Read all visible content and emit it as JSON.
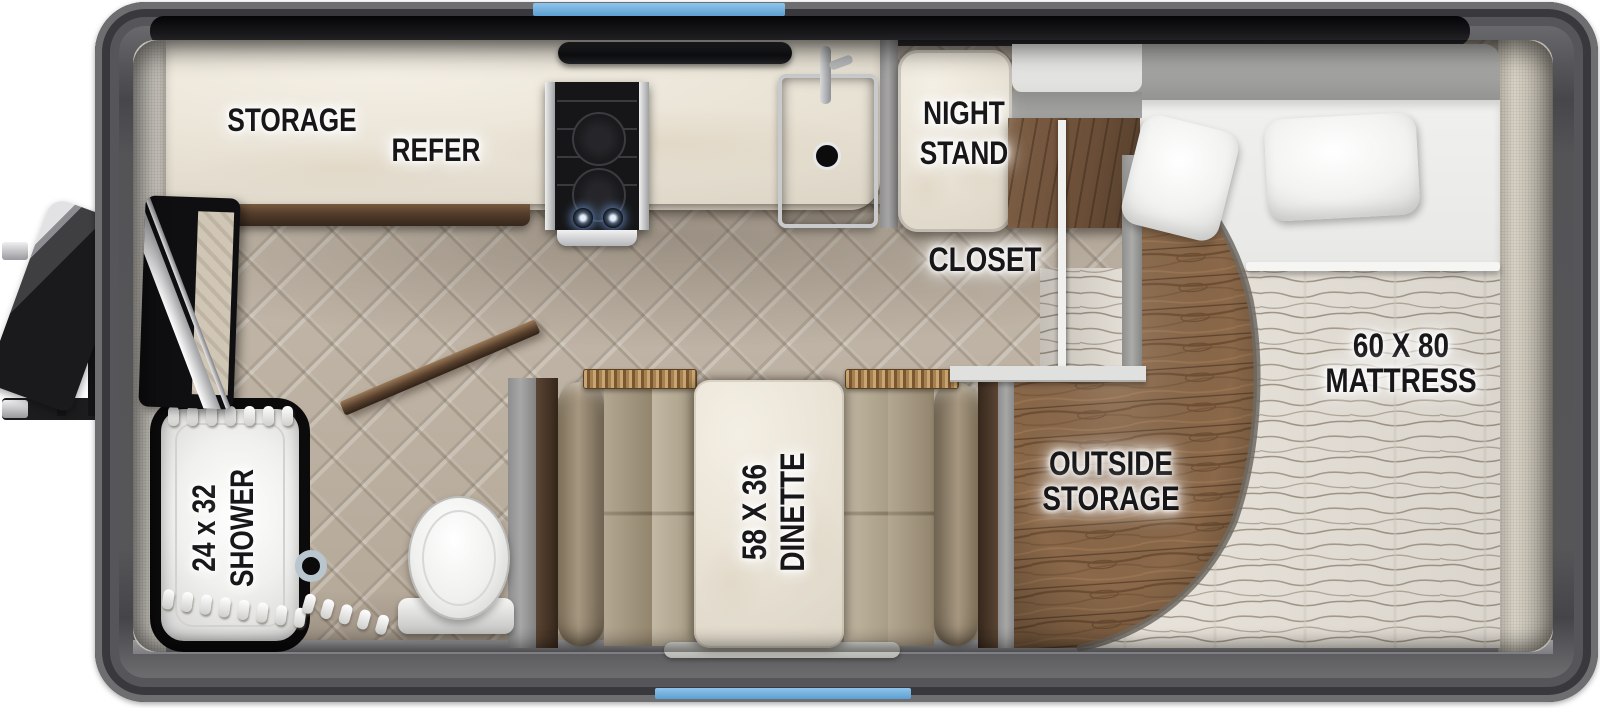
{
  "labels": {
    "storage": "STORAGE",
    "refer": "REFER",
    "night_stand_l1": "NIGHT",
    "night_stand_l2": "STAND",
    "closet": "CLOSET",
    "mattress_l1": "60 X 80",
    "mattress_l2": "MATTRESS",
    "outside_l1": "OUTSIDE",
    "outside_l2": "STORAGE",
    "dinette_l1": "58 X 36",
    "dinette_l2": "DINETTE",
    "shower_l1": "24 x 32",
    "shower_l2": "SHOWER"
  },
  "palette": {
    "accent_blue": "#6fb0df",
    "frame_gray": "#545457",
    "wood_floor_brown": "#8a6849",
    "herringbone_beige": "#c0b6a7",
    "cushion_tan": "#a69780",
    "marble_cream": "#ebe5d8",
    "mattress_cream": "#e8e3da",
    "label_ink": "#17171a"
  }
}
